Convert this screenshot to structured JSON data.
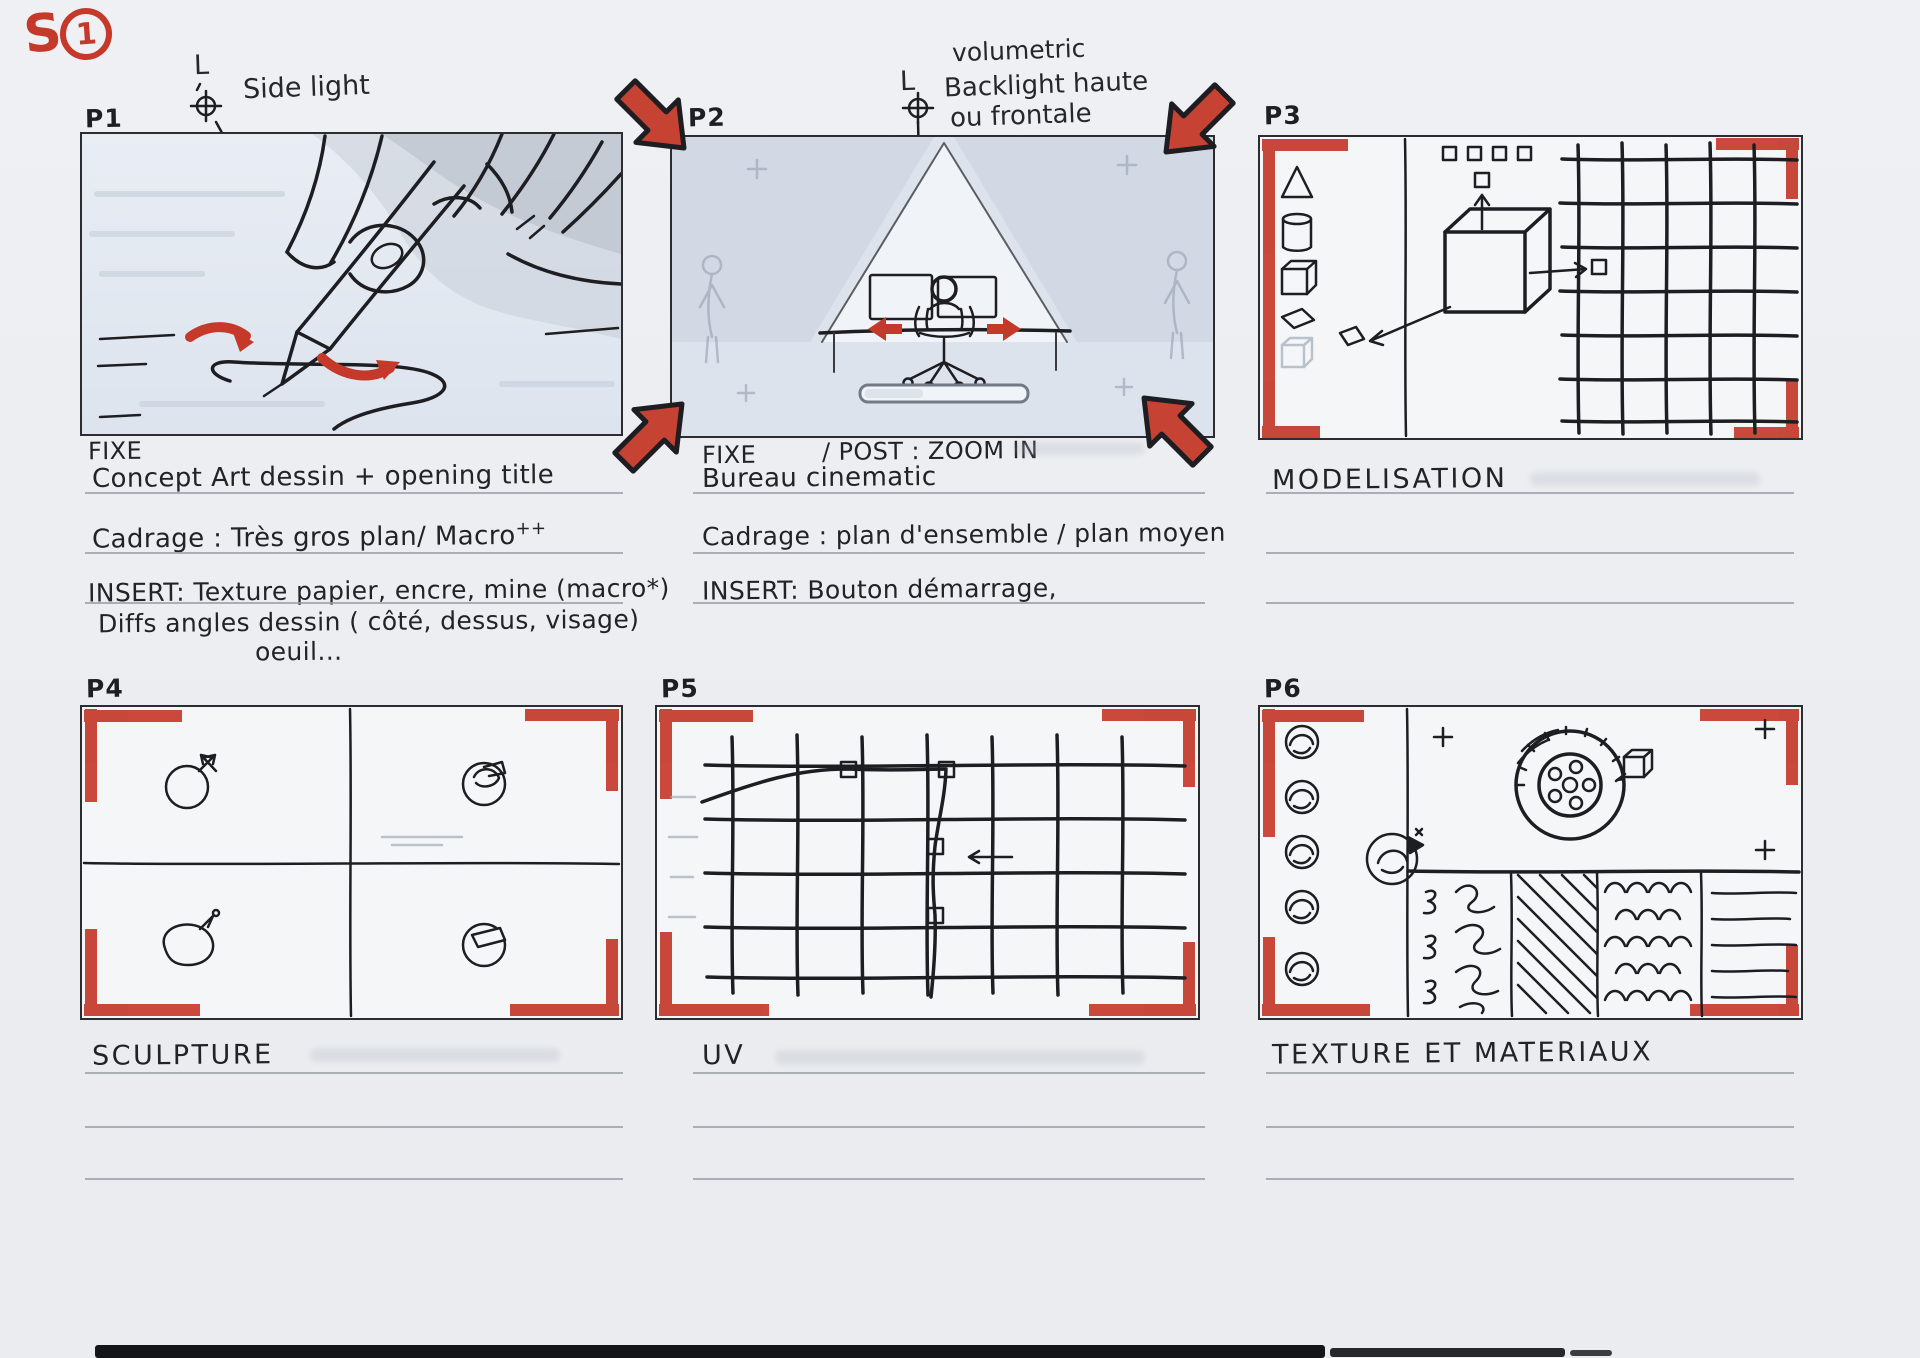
{
  "colors": {
    "marker_red": "#c5392b",
    "ink": "#1e1e22",
    "paper": "#eef0f3",
    "pencil_blue": "#dfe6ef"
  },
  "icons": {
    "light_symbol": "crosshair-circle-light-icon",
    "zoom_arrows": "thick-red-inward-arrows",
    "crop_marks": "red-corner-brackets"
  },
  "sheet_marker": {
    "letter": "S",
    "number": "1"
  },
  "panels": {
    "p1": {
      "label": "P1",
      "light_symbol": "L",
      "light_note": "Side light",
      "shot_type": "FIXE",
      "caption_1": "Concept Art dessin + opening title",
      "caption_2": "Cadrage : Très gros plan/ Macro",
      "caption_2_sup": "++",
      "caption_3": "INSERT: Texture papier, encre, mine (macro*)",
      "caption_4": "Diffs angles dessin ( côté, dessus, visage)",
      "caption_5": "oeuil..."
    },
    "p2": {
      "label": "P2",
      "light_symbol": "L",
      "light_note_1": "volumetric",
      "light_note_2": "Backlight haute",
      "light_note_3": "ou frontale",
      "shot_type": "FIXE",
      "post_note": "/ POST : ZOOM IN",
      "caption_1": "Bureau cinematic",
      "caption_2": "Cadrage : plan d'ensemble / plan moyen",
      "caption_3": "INSERT: Bouton démarrage,"
    },
    "p3": {
      "label": "P3",
      "title": "MODELISATION"
    },
    "p4": {
      "label": "P4",
      "title": "SCULPTURE"
    },
    "p5": {
      "label": "P5",
      "title": "UV"
    },
    "p6": {
      "label": "P6",
      "title": "TEXTURE ET MATERIAUX"
    }
  }
}
